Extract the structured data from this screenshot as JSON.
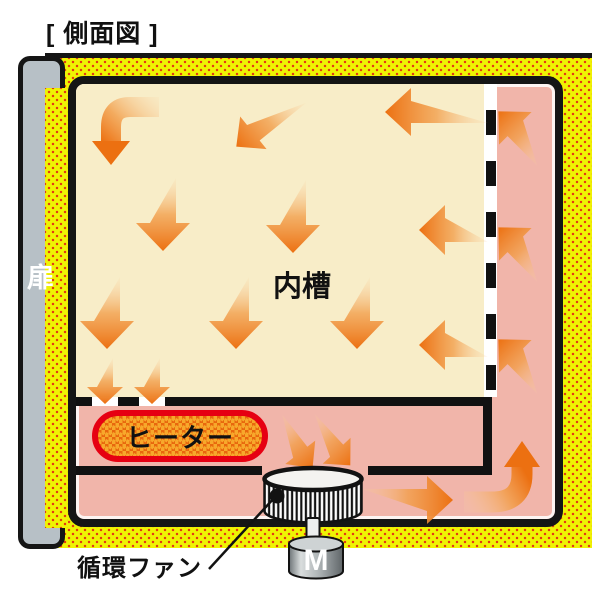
{
  "title": "[ 側面図 ]",
  "diagram": {
    "door_label": "扉",
    "chamber_label": "内槽",
    "heater_label": "ヒーター",
    "fan_label": "循環ファン",
    "motor_label": "M"
  },
  "colors": {
    "insulation_yellow": "#eff303",
    "insulation_dot_red": "#e33c12",
    "chamber_cream": "#f8edc8",
    "duct_pink": "#f1b5aa",
    "arrow_orange": "#ec7011",
    "heater_fill_orange": "#f7a82b",
    "heater_border_red": "#e60012",
    "door_gray": "#b7c0c6",
    "outline_black": "#151515"
  }
}
